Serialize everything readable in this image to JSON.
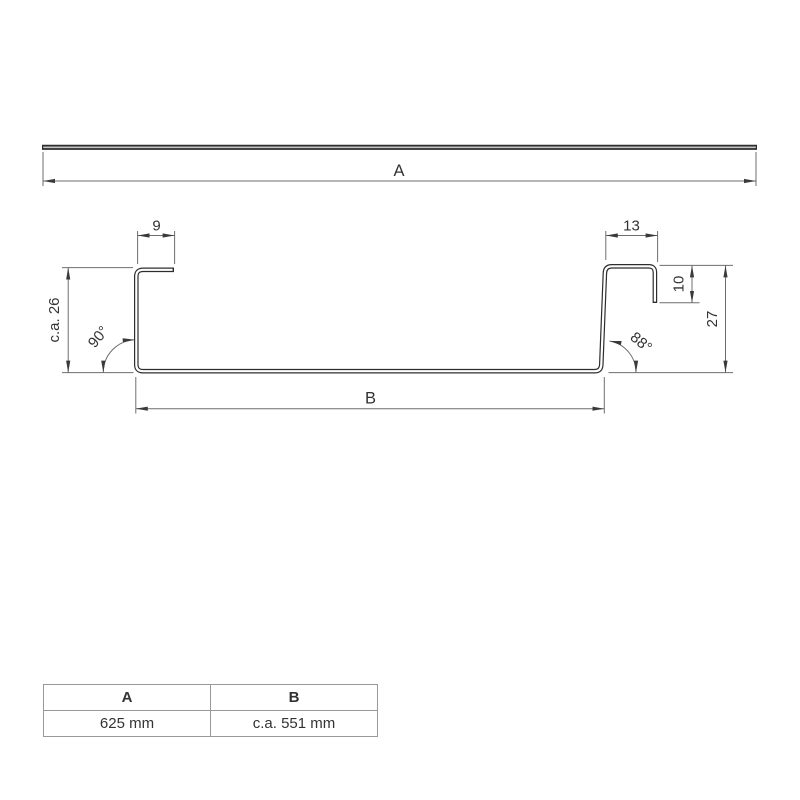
{
  "flat_sheet": {
    "description": "unbent flat sheet strip",
    "dim_label": "A"
  },
  "profile": {
    "left_flange_width_mm": "9",
    "right_flange_width_mm": "13",
    "right_hook_height_mm": "10",
    "left_height_mm": "c.a. 26",
    "right_height_mm": "27",
    "left_angle": "90°",
    "right_angle": "88°",
    "base_width_label": "B"
  },
  "dimension_table": {
    "headers": [
      "A",
      "B"
    ],
    "values": [
      "625 mm",
      "c.a. 551 mm"
    ]
  },
  "colors": {
    "profile_line": "#2d2d2d",
    "profile_core": "#ffffff",
    "strip_core": "#c4c4c4",
    "dimension_line": "#6e6e6e",
    "arrow": "#3a3a3a",
    "text": "#333333",
    "table_border": "#999999",
    "background": "#ffffff"
  }
}
